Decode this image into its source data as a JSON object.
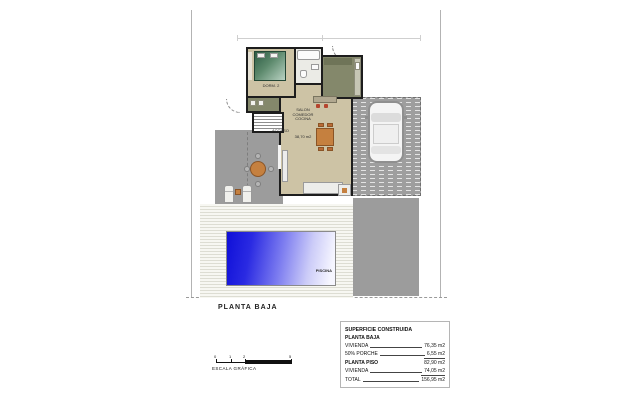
{
  "plan": {
    "title": "PLANTA BAJA",
    "labels": {
      "bedroom": "DORM. 2",
      "access": "ACCESO",
      "living_line1": "SALON",
      "living_line2": "COMEDOR",
      "living_line3": "COCINA",
      "living_area": "38,70 m2",
      "pool": "PISCINA"
    }
  },
  "scale": {
    "caption": "ESCALA GRÁFICA",
    "tick_labels": [
      "0",
      "1",
      "2",
      "5"
    ]
  },
  "summary_table": {
    "title": "SUPERFICIE CONSTRUIDA",
    "section1": "PLANTA BAJA",
    "rows1": [
      {
        "label": "VIVIENDA",
        "value": "76,35 m2"
      },
      {
        "label": "50% PORCHE",
        "value": "6,55 m2"
      }
    ],
    "section2": "PLANTA PISO",
    "subtotal_value": "82,90 m2",
    "rows2": [
      {
        "label": "VIVIENDA",
        "value": "74,05 m2"
      }
    ],
    "total_label": "TOTAL",
    "total_value": "156,95 m2"
  },
  "colors": {
    "pool_blue": "#0f0fd8",
    "floor_tan": "#cdc3a5",
    "cabinet_olive": "#84886b",
    "terrace_gray": "#9c9c9c",
    "accent_terracotta": "#c5803f",
    "wall_black": "#1d1d1d"
  }
}
